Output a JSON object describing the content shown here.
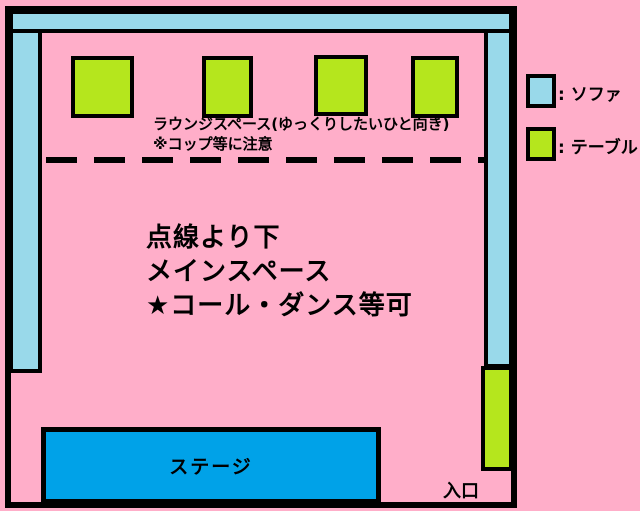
{
  "colors": {
    "background": "#FFAEC9",
    "sofa": "#99D9EA",
    "table": "#B5E61D",
    "stage": "#00A2E8",
    "outline": "#000000"
  },
  "lounge": {
    "line1": "ラウンジスペース(ゆっくりしたいひと向き)",
    "line2": "※コップ等に注意"
  },
  "main_space": {
    "line1": "点線より下",
    "line2": "メインスペース",
    "line3": "★コール・ダンス等可"
  },
  "stage": {
    "label": "ステージ"
  },
  "entrance": {
    "label": "入口"
  },
  "legend": {
    "sofa_label": ": ソファ",
    "table_label": ": テーブル"
  },
  "counts": {
    "top_tables": 4,
    "right_tables": 1
  }
}
